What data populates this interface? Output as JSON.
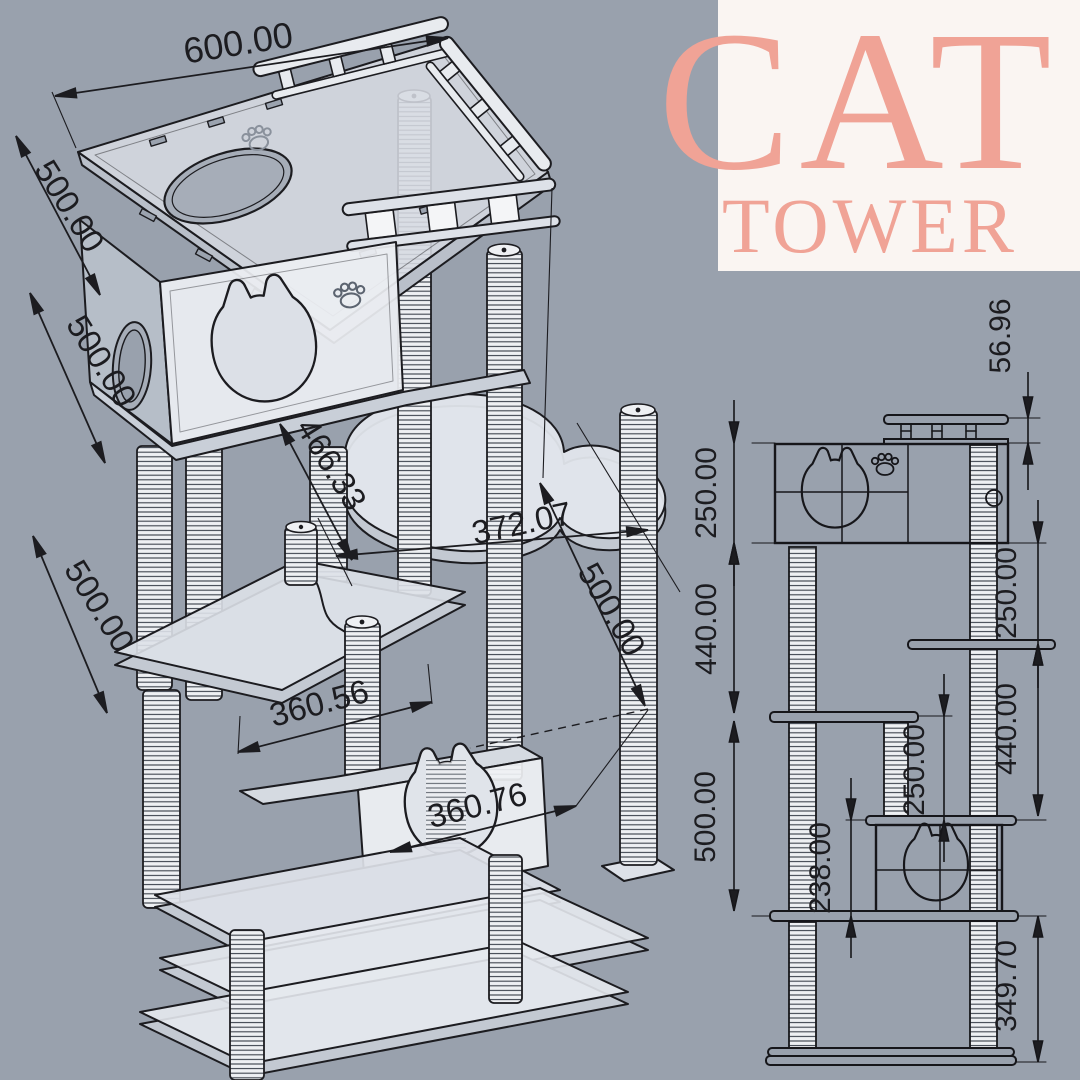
{
  "title": {
    "line1": "CAT",
    "line2": "TOWER"
  },
  "colors": {
    "background": "#99a1ad",
    "panel_bg": "#faf5f2",
    "accent": "#f0a396",
    "ink": "#1c1c20",
    "board_fill": "#dde1e8",
    "face_fill": "#edeff3"
  },
  "views": {
    "iso": {
      "name": "3D isometric view",
      "dims": {
        "top_width": "600.00",
        "top_depth": "500.00",
        "upper_height": "500.00",
        "mid_height": "500.00",
        "arm_length": "466.33",
        "perch_width": "372.07",
        "right_depth": "500.00",
        "step_width": "360.56",
        "house_width": "360.76"
      }
    },
    "side": {
      "name": "side elevation view",
      "dims": {
        "rail_height": "56.96",
        "upper_box_height": "250.00",
        "upper_right_drop": "250.00",
        "left_mid_span": "440.00",
        "right_mid_span": "440.00",
        "mid_drop": "250.00",
        "lower_span": "500.00",
        "lower_box_height": "238.00",
        "base_span": "349.70"
      }
    }
  }
}
